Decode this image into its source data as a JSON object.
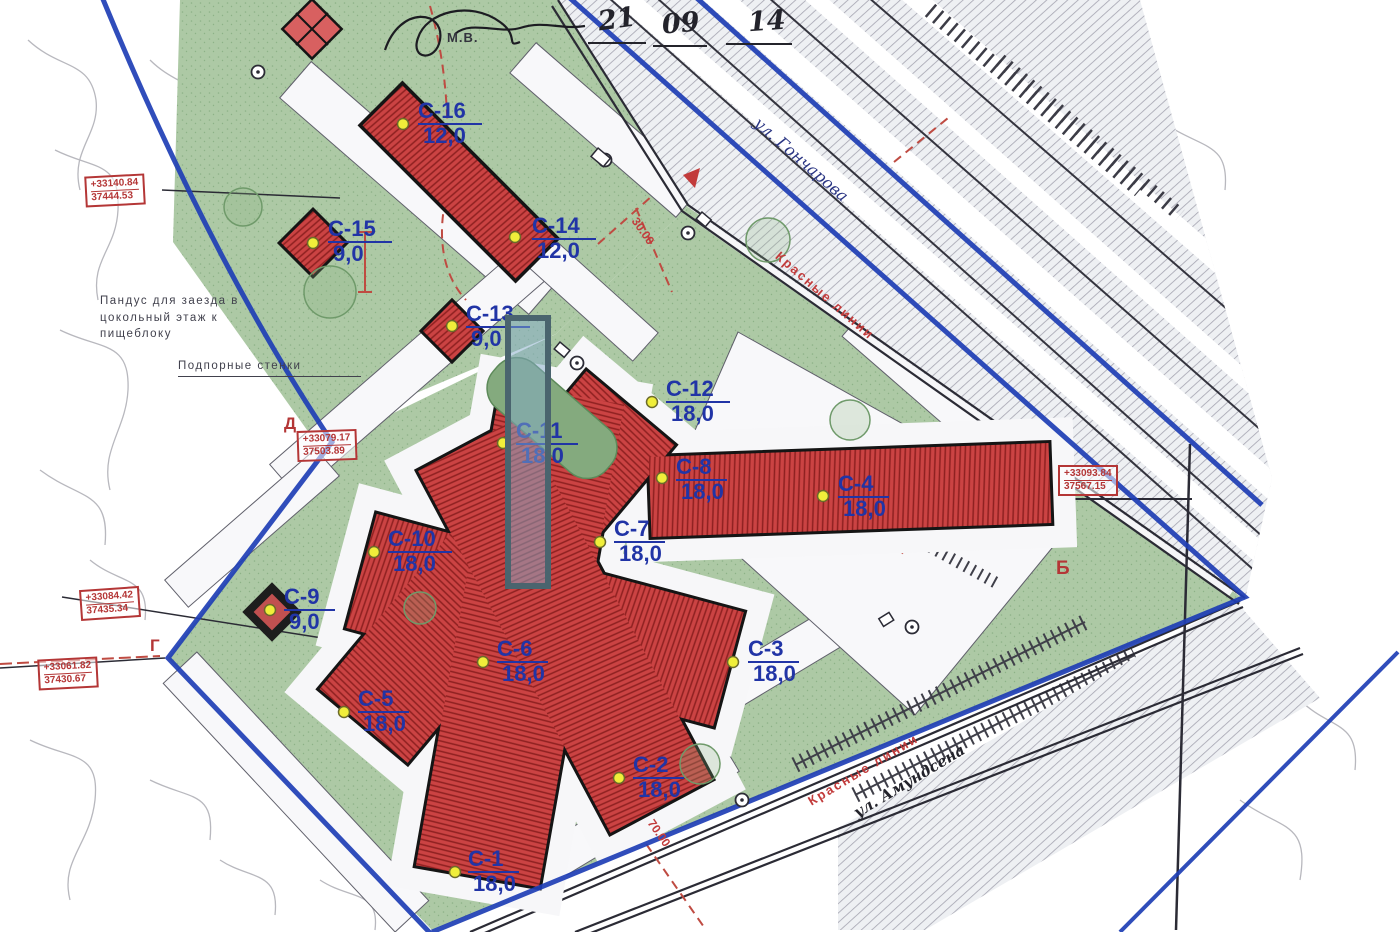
{
  "points": [
    {
      "name": "С-1",
      "depth": "18,0"
    },
    {
      "name": "С-2",
      "depth": "18,0"
    },
    {
      "name": "С-3",
      "depth": "18,0"
    },
    {
      "name": "С-4",
      "depth": "18,0"
    },
    {
      "name": "С-5",
      "depth": "18,0"
    },
    {
      "name": "С-6",
      "depth": "18,0"
    },
    {
      "name": "С-7",
      "depth": "18,0"
    },
    {
      "name": "С-8",
      "depth": "18,0"
    },
    {
      "name": "С-9",
      "depth": "9,0"
    },
    {
      "name": "С-10",
      "depth": "18,0"
    },
    {
      "name": "С-11",
      "depth": "18,0"
    },
    {
      "name": "С-12",
      "depth": "18,0"
    },
    {
      "name": "С-13",
      "depth": "9,0"
    },
    {
      "name": "С-14",
      "depth": "12,0"
    },
    {
      "name": "С-15",
      "depth": "9,0"
    },
    {
      "name": "С-16",
      "depth": "12,0"
    }
  ],
  "coord_boxes": [
    {
      "x": "+33140.84",
      "y": "37444.53"
    },
    {
      "x": "+33079.17",
      "y": "37503.89"
    },
    {
      "x": "+33084.42",
      "y": "37435.34"
    },
    {
      "x": "+33061.82",
      "y": "37430.67"
    },
    {
      "x": "+33093.84",
      "y": "37567.15"
    }
  ],
  "notes": {
    "ramp": "Пандус для заезда в\nцокольный этаж к\nпищеблоку",
    "walls": "Подпорные стенки"
  },
  "red_labels": {
    "red_lines": "Красные линии",
    "dim_30": "30.00",
    "dim_70": "70.00"
  },
  "streets": {
    "top": "ул. Гончарова",
    "bottom": "ул. Амундсена"
  },
  "handwriting": {
    "d1": "21",
    "d2": "09",
    "d3": "14",
    "initials": "М.В."
  },
  "letters": {
    "b": "Б",
    "g": "Г",
    "d": "Д"
  },
  "colors": {
    "boundary": "#1e3eb5",
    "building": "#ce4343",
    "green": "#abc9a3",
    "label": "#2134a6",
    "red": "#b43636",
    "overlay": "#4a646e"
  }
}
